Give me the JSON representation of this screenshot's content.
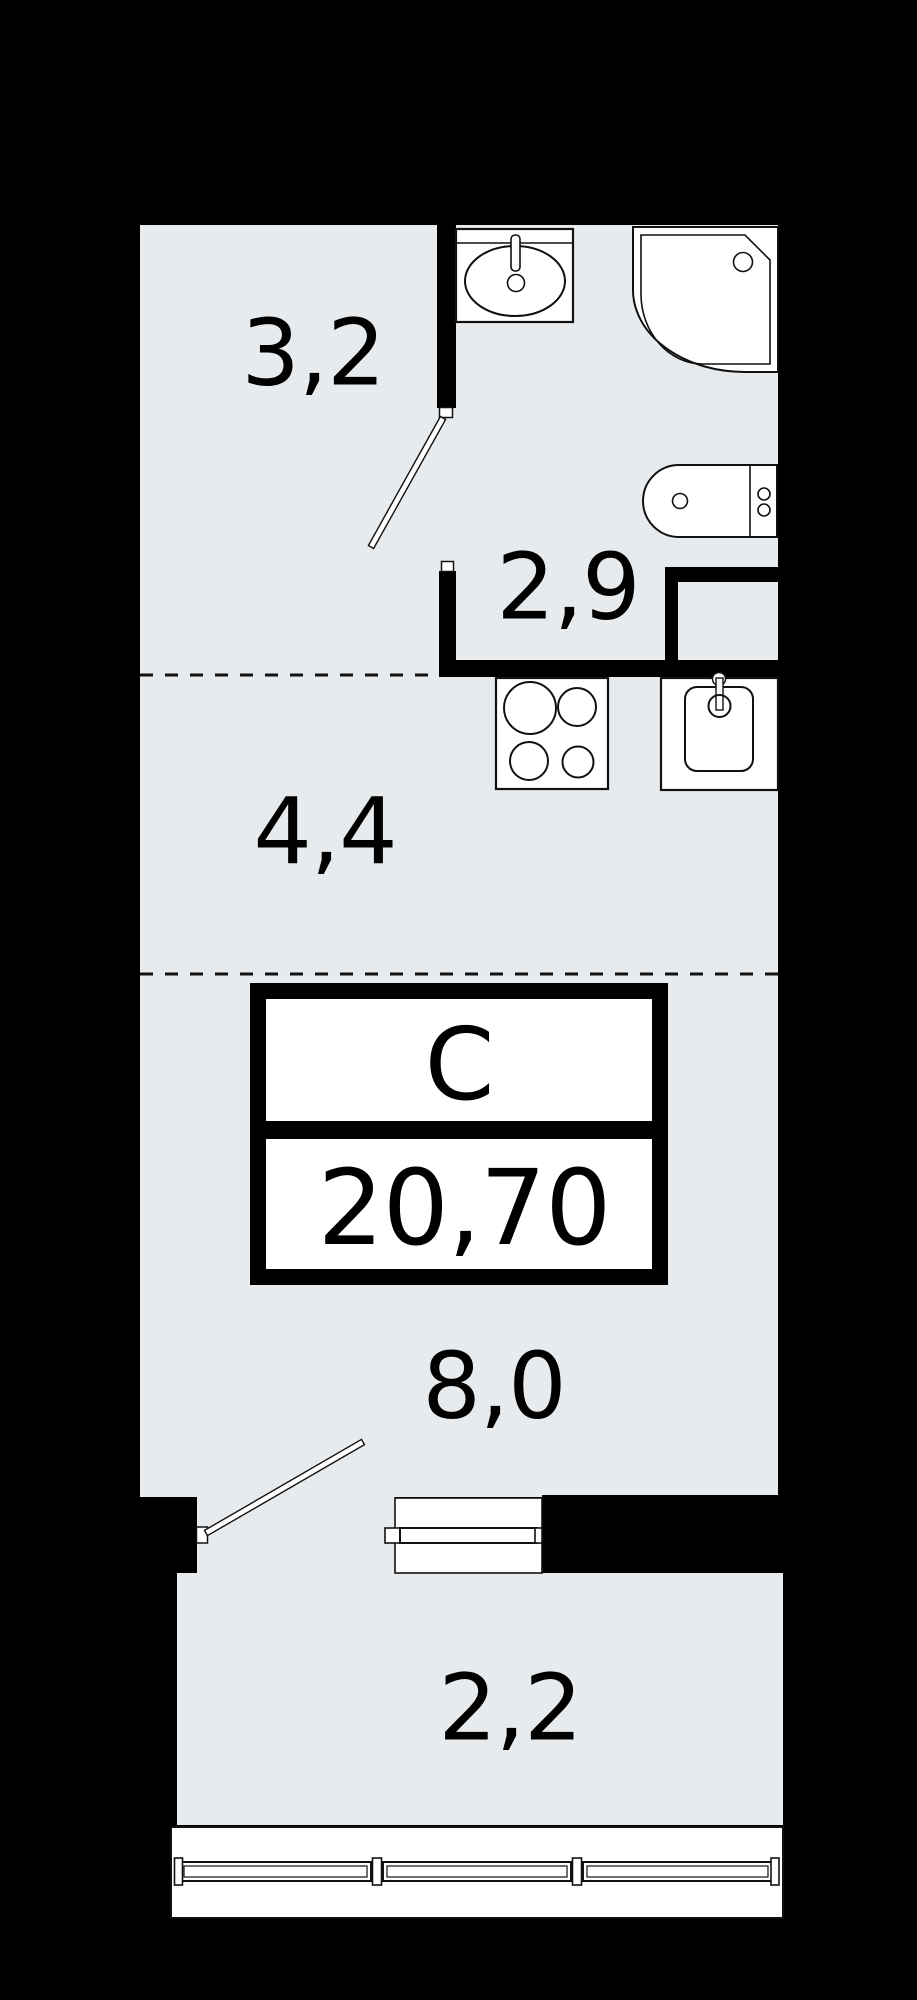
{
  "colors": {
    "background": "#000000",
    "wall": "#000000",
    "floor": "#e8ebee",
    "fixture_fill": "#ffffff",
    "line": "#111111"
  },
  "stamp": {
    "type_label": "С",
    "area_value": "20,70"
  },
  "rooms": [
    {
      "name": "hallway",
      "label": "3,2"
    },
    {
      "name": "bathroom",
      "label": "2,9"
    },
    {
      "name": "kitchen",
      "label": "4,4"
    },
    {
      "name": "living-room",
      "label": "8,0"
    },
    {
      "name": "balcony",
      "label": "2,2"
    }
  ],
  "fixtures": [
    "bathroom-sink",
    "shower-tray",
    "washing-machine",
    "stove",
    "kitchen-sink",
    "bathroom-door",
    "balcony-door",
    "balcony-window",
    "balcony-glazing"
  ]
}
